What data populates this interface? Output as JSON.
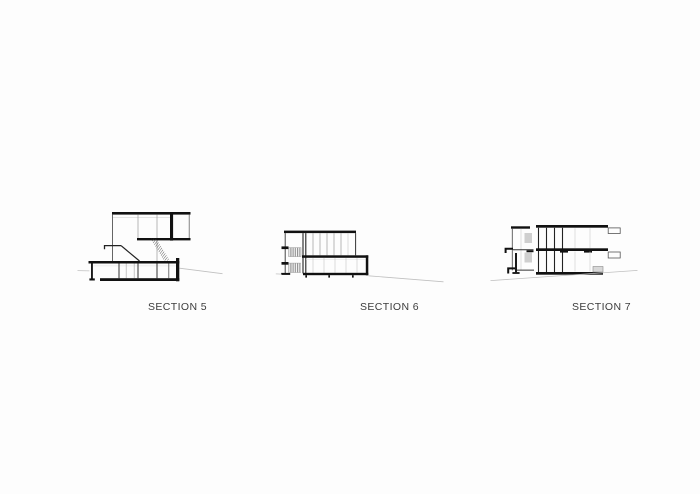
{
  "document": {
    "background_color": "#fdfdfd",
    "ink_color": "#1a1a1a",
    "ground_line_color": "#c0c0c0",
    "label_color": "#3c3c3c"
  },
  "figures": [
    {
      "label": "SECTION 5"
    },
    {
      "label": "SECTION 6"
    },
    {
      "label": "SECTION 7"
    }
  ]
}
